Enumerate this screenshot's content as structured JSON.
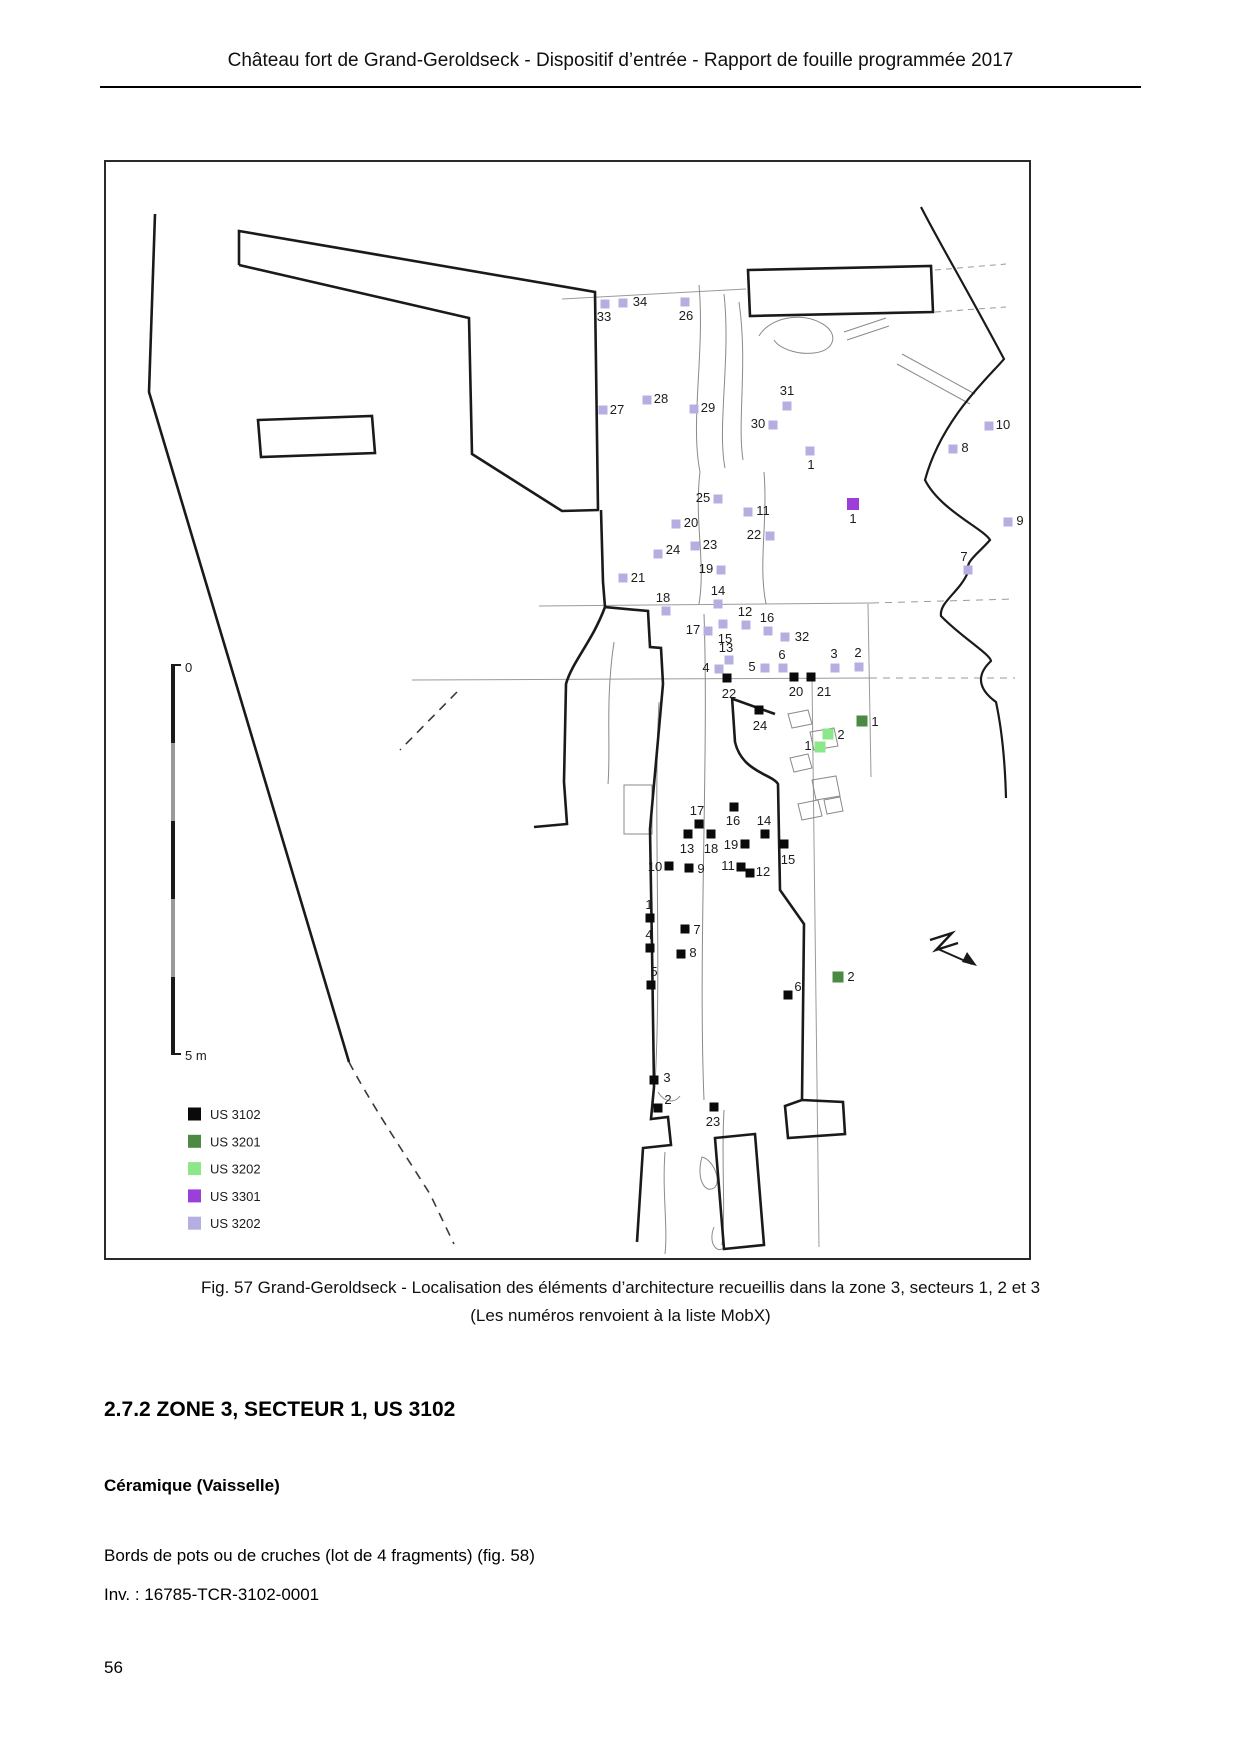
{
  "header": {
    "title": "Château fort de Grand-Geroldseck - Dispositif d’entrée - Rapport de fouille programmée 2017"
  },
  "colors": {
    "us3102": "#0a0a0a",
    "us3201": "#4a8a42",
    "us3202": "#8ce788",
    "us3301": "#9b3fd8",
    "us3202l": "#b4afe0"
  },
  "figure": {
    "caption_line1": "Fig. 57 Grand-Geroldseck - Localisation des éléments d’architecture recueillis dans la zone 3, secteurs 1, 2 et 3",
    "caption_line2": "(Les numéros renvoient à la liste MobX)",
    "scale_bar": {
      "top_label": "0",
      "bottom_label": "5 m"
    },
    "legend": {
      "items": [
        {
          "label": "US 3102",
          "color": "#0a0a0a"
        },
        {
          "label": "US 3201",
          "color": "#4a8a42"
        },
        {
          "label": "US 3202",
          "color": "#8ce788"
        },
        {
          "label": "US 3301",
          "color": "#9b3fd8"
        },
        {
          "label": "US 3202",
          "color": "#b4afe0"
        }
      ]
    },
    "points": [
      {
        "n": "33",
        "g": "us3202l",
        "x": 603,
        "y": 302,
        "lx": 602,
        "ly": 315
      },
      {
        "n": "34",
        "g": "us3202l",
        "x": 621,
        "y": 301,
        "lx": 638,
        "ly": 300
      },
      {
        "n": "26",
        "g": "us3202l",
        "x": 683,
        "y": 300,
        "lx": 684,
        "ly": 314
      },
      {
        "n": "27",
        "g": "us3202l",
        "x": 601,
        "y": 408,
        "lx": 615,
        "ly": 408
      },
      {
        "n": "28",
        "g": "us3202l",
        "x": 645,
        "y": 398,
        "lx": 659,
        "ly": 397
      },
      {
        "n": "29",
        "g": "us3202l",
        "x": 692,
        "y": 407,
        "lx": 706,
        "ly": 406
      },
      {
        "n": "31",
        "g": "us3202l",
        "x": 785,
        "y": 404,
        "lx": 785,
        "ly": 389
      },
      {
        "n": "30",
        "g": "us3202l",
        "x": 771,
        "y": 423,
        "lx": 756,
        "ly": 422
      },
      {
        "n": "1",
        "g": "us3202l",
        "x": 808,
        "y": 449,
        "lx": 809,
        "ly": 463
      },
      {
        "n": "10",
        "g": "us3202l",
        "x": 987,
        "y": 424,
        "lx": 1001,
        "ly": 423
      },
      {
        "n": "8",
        "g": "us3202l",
        "x": 951,
        "y": 447,
        "lx": 963,
        "ly": 446
      },
      {
        "n": "9",
        "g": "us3202l",
        "x": 1006,
        "y": 520,
        "lx": 1018,
        "ly": 519
      },
      {
        "n": "7",
        "g": "us3202l",
        "x": 966,
        "y": 568,
        "lx": 962,
        "ly": 555
      },
      {
        "n": "25",
        "g": "us3202l",
        "x": 716,
        "y": 497,
        "lx": 701,
        "ly": 496
      },
      {
        "n": "11",
        "g": "us3202l",
        "x": 746,
        "y": 510,
        "lx": 761,
        "ly": 509
      },
      {
        "n": "20",
        "g": "us3202l",
        "x": 674,
        "y": 522,
        "lx": 689,
        "ly": 521
      },
      {
        "n": "22",
        "g": "us3202l",
        "x": 768,
        "y": 534,
        "lx": 752,
        "ly": 533
      },
      {
        "n": "23",
        "g": "us3202l",
        "x": 693,
        "y": 544,
        "lx": 708,
        "ly": 543
      },
      {
        "n": "24",
        "g": "us3202l",
        "x": 656,
        "y": 552,
        "lx": 671,
        "ly": 548
      },
      {
        "n": "21",
        "g": "us3202l",
        "x": 621,
        "y": 576,
        "lx": 636,
        "ly": 576
      },
      {
        "n": "19",
        "g": "us3202l",
        "x": 719,
        "y": 568,
        "lx": 704,
        "ly": 567
      },
      {
        "n": "18",
        "g": "us3202l",
        "x": 664,
        "y": 609,
        "lx": 661,
        "ly": 596
      },
      {
        "n": "14",
        "g": "us3202l",
        "x": 716,
        "y": 602,
        "lx": 716,
        "ly": 589
      },
      {
        "n": "12",
        "g": "us3202l",
        "x": 744,
        "y": 623,
        "lx": 743,
        "ly": 610
      },
      {
        "n": "16",
        "g": "us3202l",
        "x": 766,
        "y": 629,
        "lx": 765,
        "ly": 616
      },
      {
        "n": "17",
        "g": "us3202l",
        "x": 706,
        "y": 629,
        "lx": 691,
        "ly": 628
      },
      {
        "n": "15",
        "g": "us3202l",
        "x": 721,
        "y": 622,
        "lx": 723,
        "ly": 637
      },
      {
        "n": "32",
        "g": "us3202l",
        "x": 783,
        "y": 635,
        "lx": 800,
        "ly": 635
      },
      {
        "n": "13",
        "g": "us3202l",
        "x": 727,
        "y": 658,
        "lx": 724,
        "ly": 646
      },
      {
        "n": "4",
        "g": "us3202l",
        "x": 717,
        "y": 667,
        "lx": 704,
        "ly": 666
      },
      {
        "n": "5",
        "g": "us3202l",
        "x": 763,
        "y": 666,
        "lx": 750,
        "ly": 665
      },
      {
        "n": "6",
        "g": "us3202l",
        "x": 781,
        "y": 666,
        "lx": 780,
        "ly": 653
      },
      {
        "n": "3",
        "g": "us3202l",
        "x": 833,
        "y": 666,
        "lx": 832,
        "ly": 652
      },
      {
        "n": "2",
        "g": "us3202l",
        "x": 857,
        "y": 665,
        "lx": 856,
        "ly": 651
      },
      {
        "n": "1",
        "g": "us3301",
        "x": 851,
        "y": 502,
        "lx": 851,
        "ly": 517
      },
      {
        "n": "22",
        "g": "us3102",
        "x": 725,
        "y": 676,
        "lx": 727,
        "ly": 692
      },
      {
        "n": "20",
        "g": "us3102",
        "x": 792,
        "y": 675,
        "lx": 794,
        "ly": 690
      },
      {
        "n": "21",
        "g": "us3102",
        "x": 809,
        "y": 675,
        "lx": 822,
        "ly": 690
      },
      {
        "n": "24",
        "g": "us3102",
        "x": 757,
        "y": 708,
        "lx": 758,
        "ly": 724
      },
      {
        "n": "1",
        "g": "us3201",
        "x": 860,
        "y": 719,
        "lx": 873,
        "ly": 720
      },
      {
        "n": "2",
        "g": "us3201",
        "x": 836,
        "y": 975,
        "lx": 849,
        "ly": 975
      },
      {
        "n": "2",
        "g": "us3202",
        "x": 826,
        "y": 732,
        "lx": 839,
        "ly": 733
      },
      {
        "n": "1",
        "g": "us3202",
        "x": 818,
        "y": 745,
        "lx": 806,
        "ly": 744
      },
      {
        "n": "17",
        "g": "us3102",
        "x": 697,
        "y": 822,
        "lx": 695,
        "ly": 809
      },
      {
        "n": "16",
        "g": "us3102",
        "x": 732,
        "y": 805,
        "lx": 731,
        "ly": 819
      },
      {
        "n": "14",
        "g": "us3102",
        "x": 763,
        "y": 832,
        "lx": 762,
        "ly": 819
      },
      {
        "n": "13",
        "g": "us3102",
        "x": 686,
        "y": 832,
        "lx": 685,
        "ly": 847
      },
      {
        "n": "18",
        "g": "us3102",
        "x": 709,
        "y": 832,
        "lx": 709,
        "ly": 847
      },
      {
        "n": "19",
        "g": "us3102",
        "x": 743,
        "y": 842,
        "lx": 729,
        "ly": 843
      },
      {
        "n": "15",
        "g": "us3102",
        "x": 782,
        "y": 842,
        "lx": 786,
        "ly": 858
      },
      {
        "n": "10",
        "g": "us3102",
        "x": 667,
        "y": 864,
        "lx": 653,
        "ly": 865
      },
      {
        "n": "9",
        "g": "us3102",
        "x": 687,
        "y": 866,
        "lx": 699,
        "ly": 867
      },
      {
        "n": "11",
        "g": "us3102",
        "x": 739,
        "y": 865,
        "lx": 726,
        "ly": 864
      },
      {
        "n": "12",
        "g": "us3102",
        "x": 748,
        "y": 871,
        "lx": 761,
        "ly": 870
      },
      {
        "n": "1",
        "g": "us3102",
        "x": 648,
        "y": 916,
        "lx": 647,
        "ly": 903
      },
      {
        "n": "4",
        "g": "us3102",
        "x": 648,
        "y": 946,
        "lx": 647,
        "ly": 933
      },
      {
        "n": "7",
        "g": "us3102",
        "x": 683,
        "y": 927,
        "lx": 695,
        "ly": 928
      },
      {
        "n": "8",
        "g": "us3102",
        "x": 679,
        "y": 952,
        "lx": 691,
        "ly": 951
      },
      {
        "n": "5",
        "g": "us3102",
        "x": 649,
        "y": 983,
        "lx": 652,
        "ly": 970
      },
      {
        "n": "6",
        "g": "us3102",
        "x": 786,
        "y": 993,
        "lx": 796,
        "ly": 985
      },
      {
        "n": "3",
        "g": "us3102",
        "x": 652,
        "y": 1078,
        "lx": 665,
        "ly": 1076
      },
      {
        "n": "2",
        "g": "us3102",
        "x": 656,
        "y": 1106,
        "lx": 666,
        "ly": 1098
      },
      {
        "n": "23",
        "g": "us3102",
        "x": 712,
        "y": 1105,
        "lx": 711,
        "ly": 1120
      }
    ]
  },
  "section": {
    "heading": "2.7.2 ZONE 3, SECTEUR 1, US 3102",
    "subheading": "Céramique (Vaisselle)",
    "body_line1": "Bords de pots ou de cruches (lot de 4 fragments) (fig. 58)",
    "body_line2": "Inv. : 16785-TCR-3102-0001"
  },
  "footer": {
    "page_number": "56"
  }
}
